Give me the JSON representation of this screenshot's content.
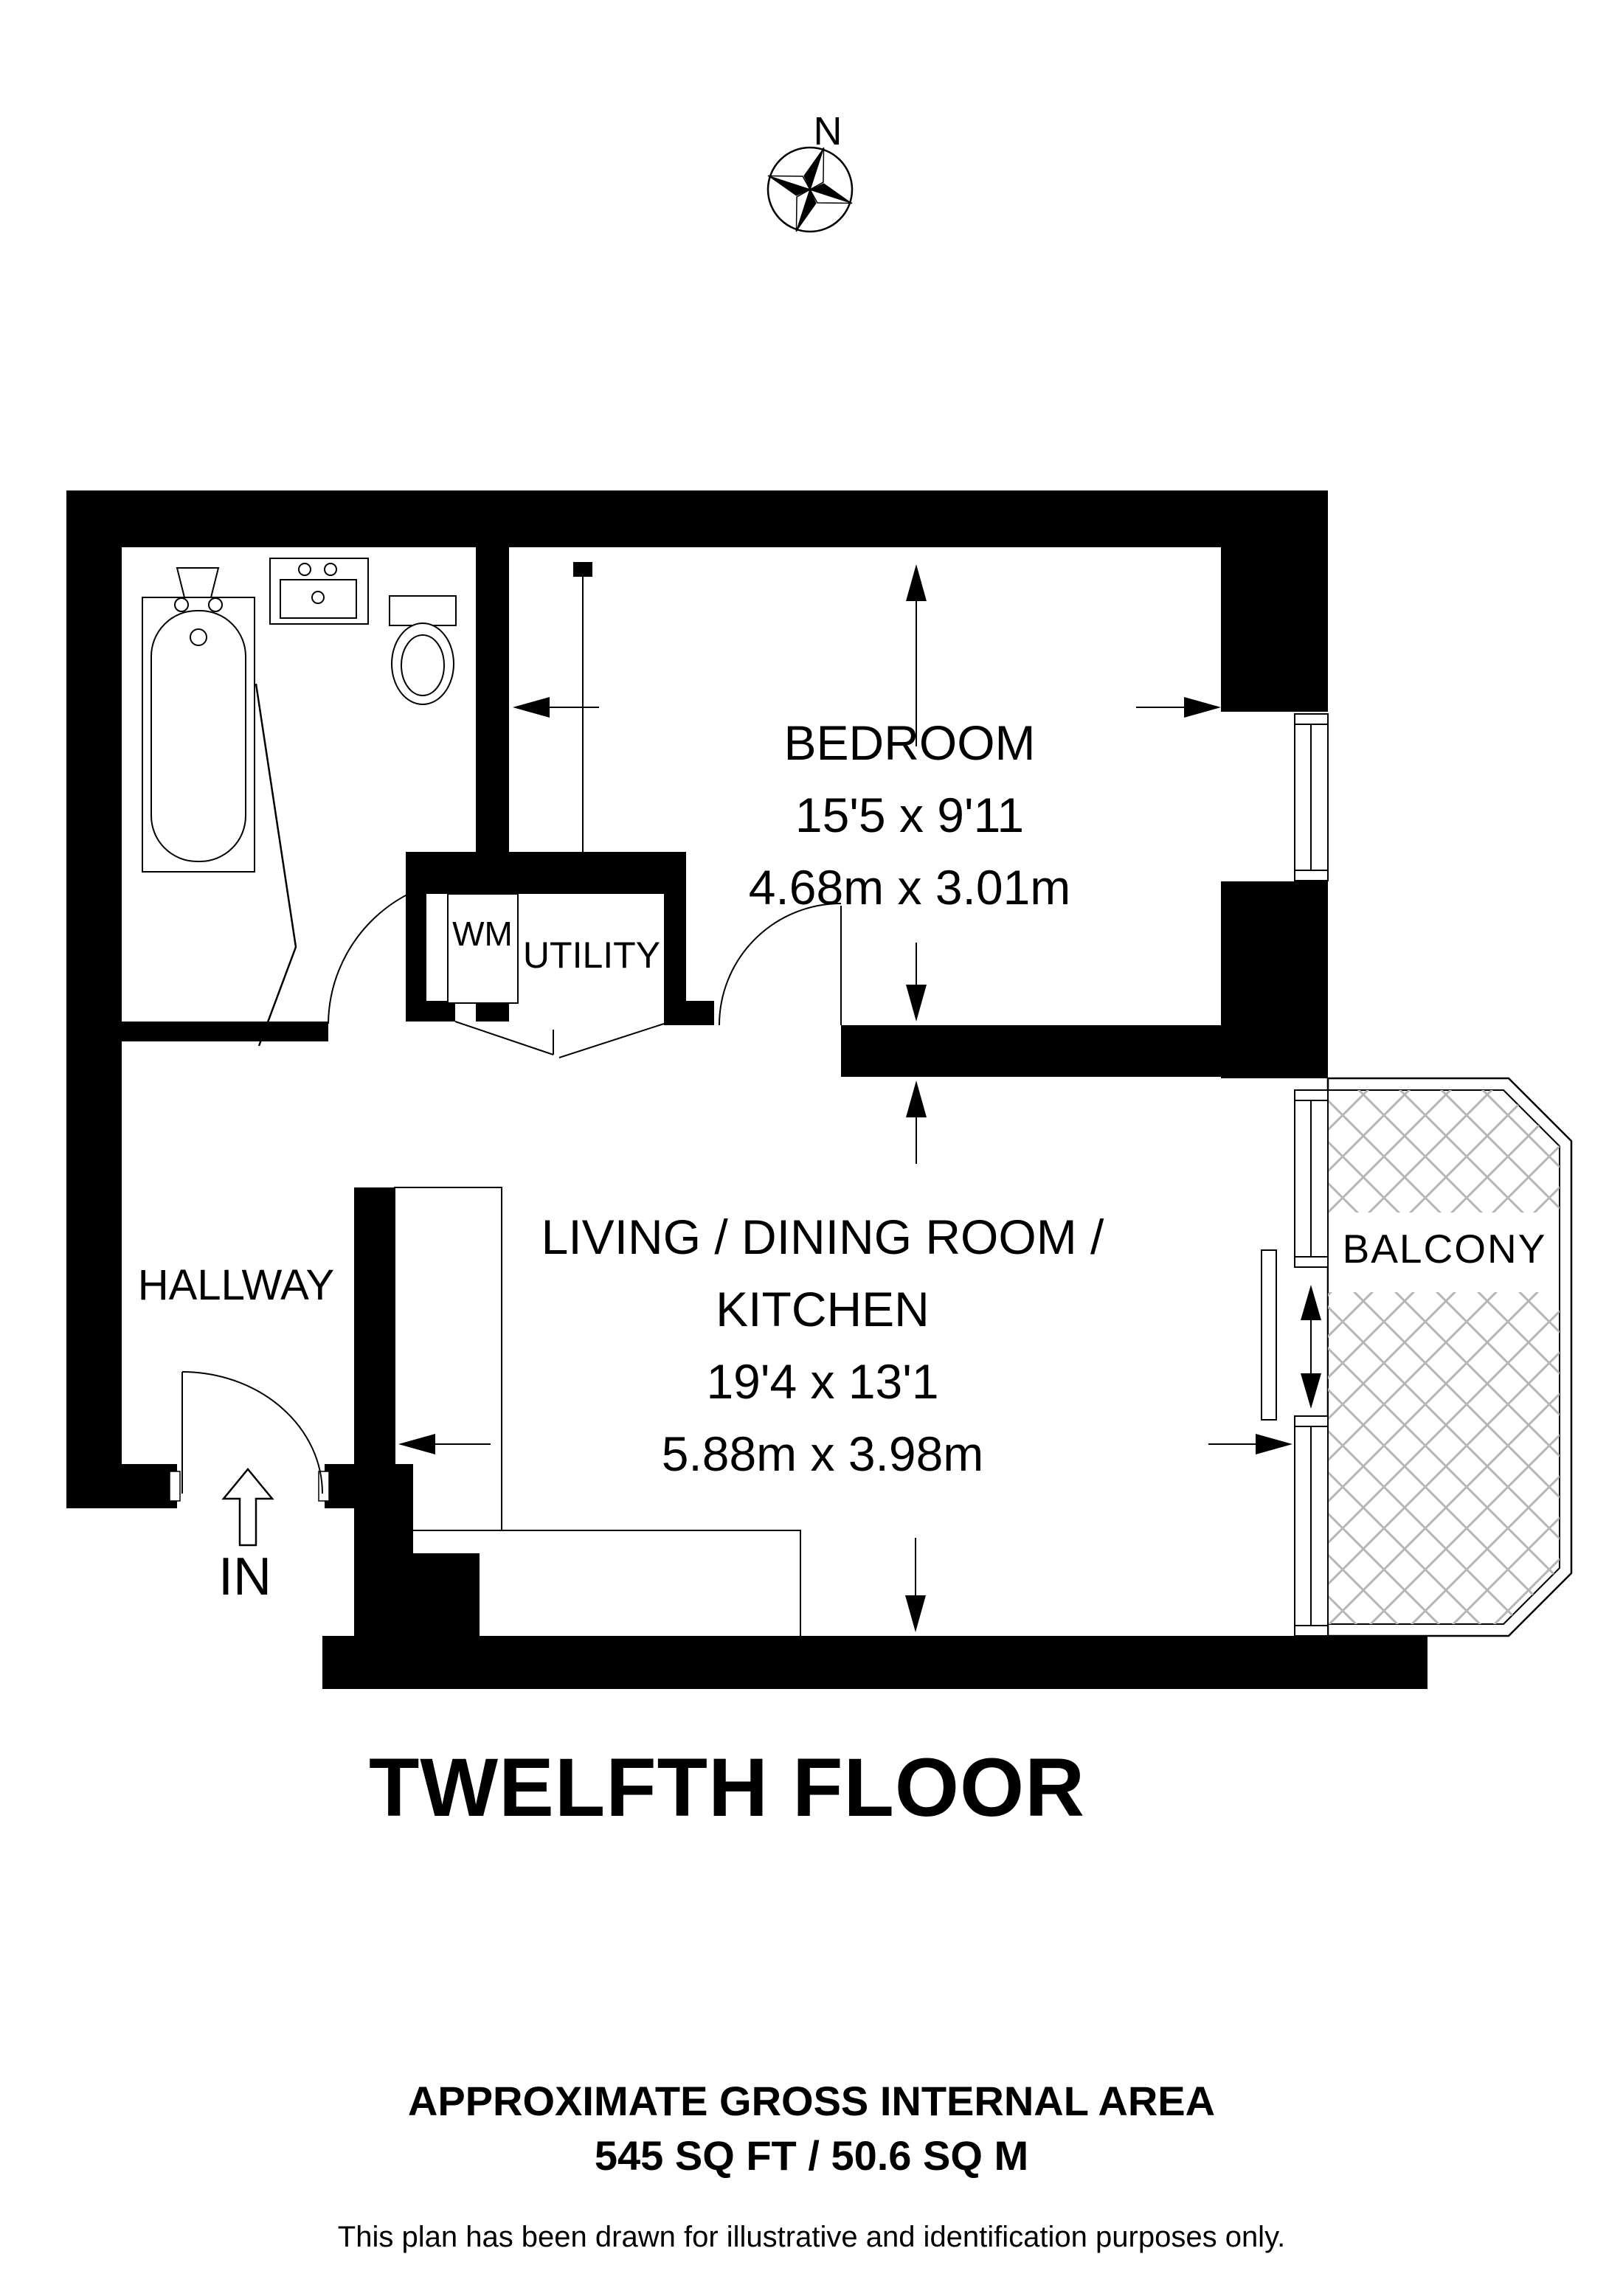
{
  "compass": {
    "north_label": "N"
  },
  "rooms": {
    "bedroom": {
      "name": "BEDROOM",
      "dims_imperial": "15'5 x 9'11",
      "dims_metric": "4.68m x 3.01m"
    },
    "living": {
      "name_line1": "LIVING / DINING ROOM /",
      "name_line2": "KITCHEN",
      "dims_imperial": "19'4 x 13'1",
      "dims_metric": "5.88m x 3.98m"
    },
    "hallway": {
      "name": "HALLWAY"
    },
    "utility": {
      "name": "UTILITY",
      "wm_label": "WM"
    },
    "balcony": {
      "name": "BALCONY"
    }
  },
  "entrance": {
    "label": "IN"
  },
  "floor_title": "TWELFTH FLOOR",
  "footer": {
    "area_heading": "APPROXIMATE GROSS INTERNAL AREA",
    "area_value": "545 SQ FT / 50.6 SQ M",
    "disclaimer": "This plan has been drawn for illustrative and identification purposes only."
  },
  "colors": {
    "wall": "#000000",
    "hatch": "#b5b5b5",
    "background": "#ffffff"
  }
}
